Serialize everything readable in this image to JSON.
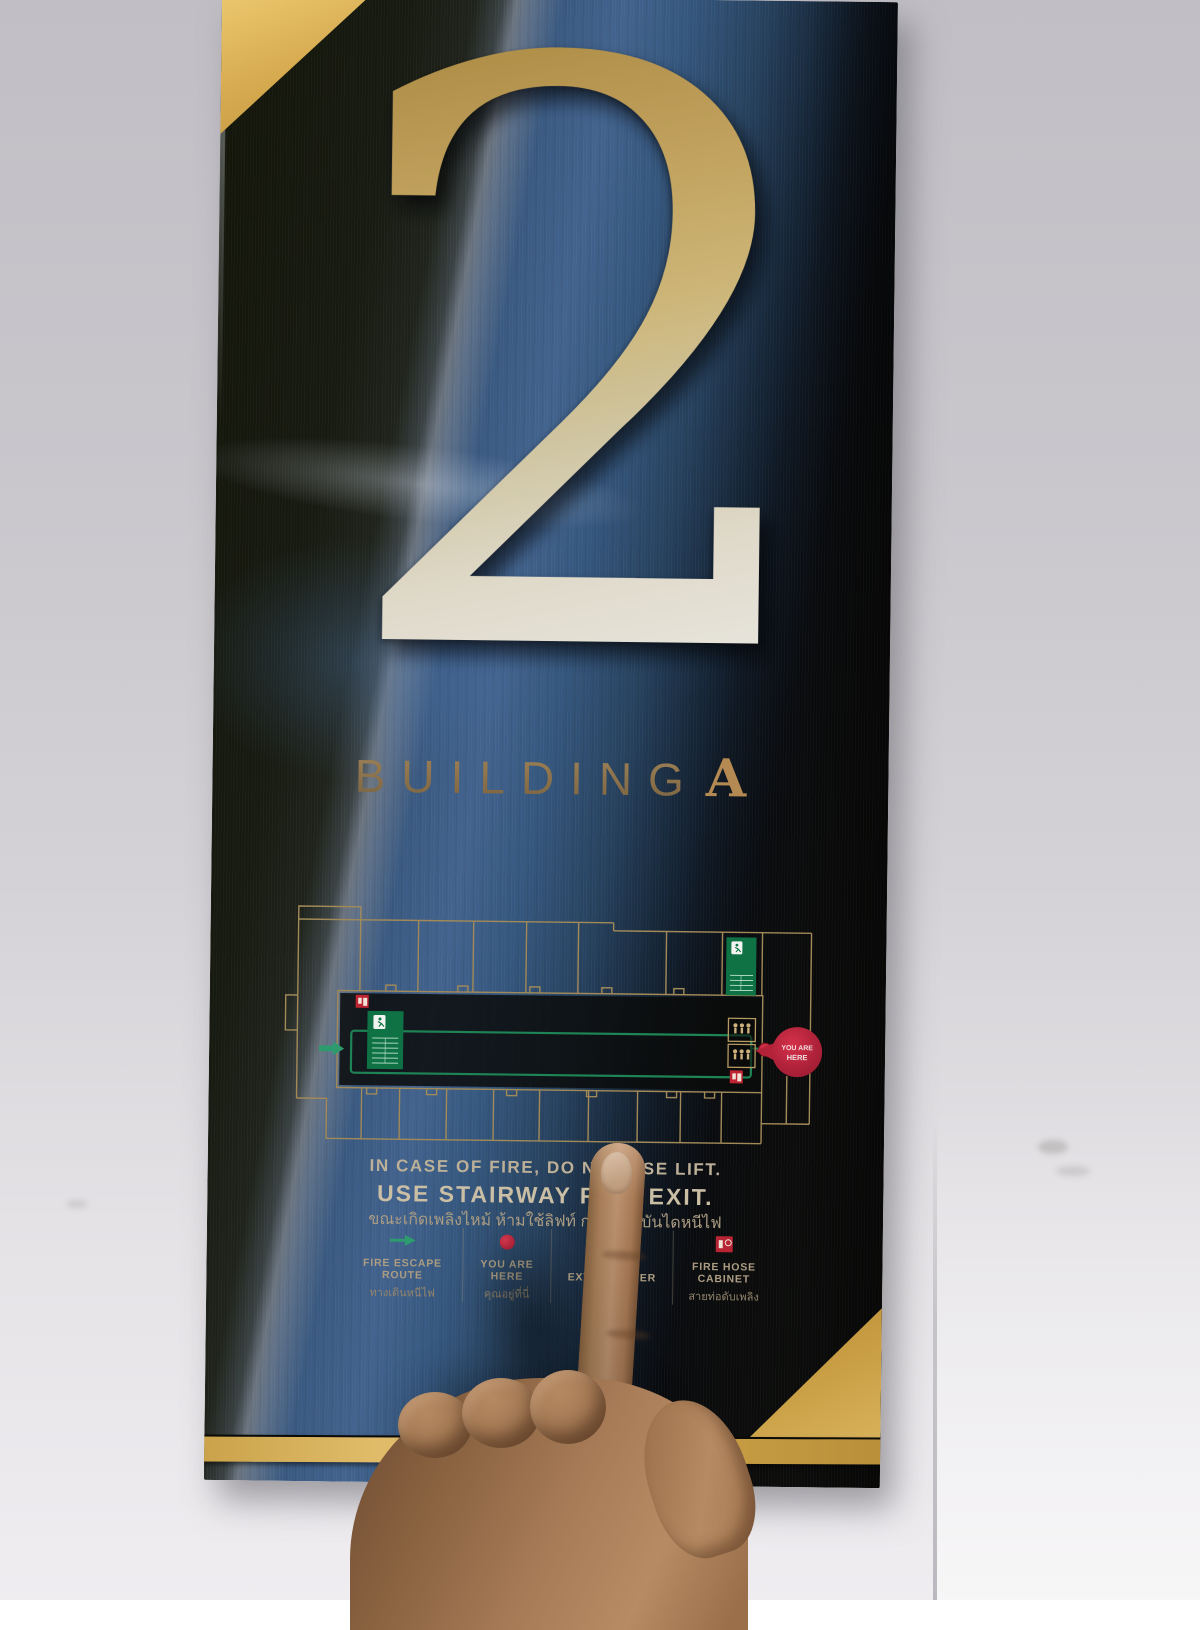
{
  "sign": {
    "floor_number": "2",
    "building_word": "BUILDING",
    "building_letter": "A",
    "notice_en_line1": "IN CASE OF FIRE, DO NOT USE LIFT.",
    "notice_en_line2": "USE STAIRWAY FIRE EXIT.",
    "notice_th": "ขณะเกิดเพลิงไหม้ ห้ามใช้ลิฟท์ กรุณาใช้บันไดหนีไฟ",
    "legend": [
      {
        "icon": "escape-route-arrow-icon",
        "label": "FIRE ESCAPE ROUTE",
        "label_thai": "ทางเดินหนีไฟ"
      },
      {
        "icon": "you-are-here-dot-icon",
        "label": "YOU ARE HERE",
        "label_thai": "คุณอยู่ที่นี่"
      },
      {
        "icon": "fire-extinguisher-icon",
        "label": "FIRE EXTINGUISHER",
        "label_thai": "ถังดับเพลิง",
        "obscured_by_finger": true
      },
      {
        "icon": "fire-hose-cabinet-icon",
        "label": "FIRE HOSE CABINET",
        "label_thai": "สายท่อดับเพลิง"
      }
    ],
    "floor_plan": {
      "you_are_here_line1": "YOU ARE",
      "you_are_here_line2": "HERE"
    },
    "colors": {
      "gold": "#c89d45",
      "panel_blue": "#3c5c85",
      "panel_dark": "#141610",
      "route_green": "#0e7245",
      "marker_red": "#c22438",
      "text_beige": "#bfae8e"
    }
  }
}
